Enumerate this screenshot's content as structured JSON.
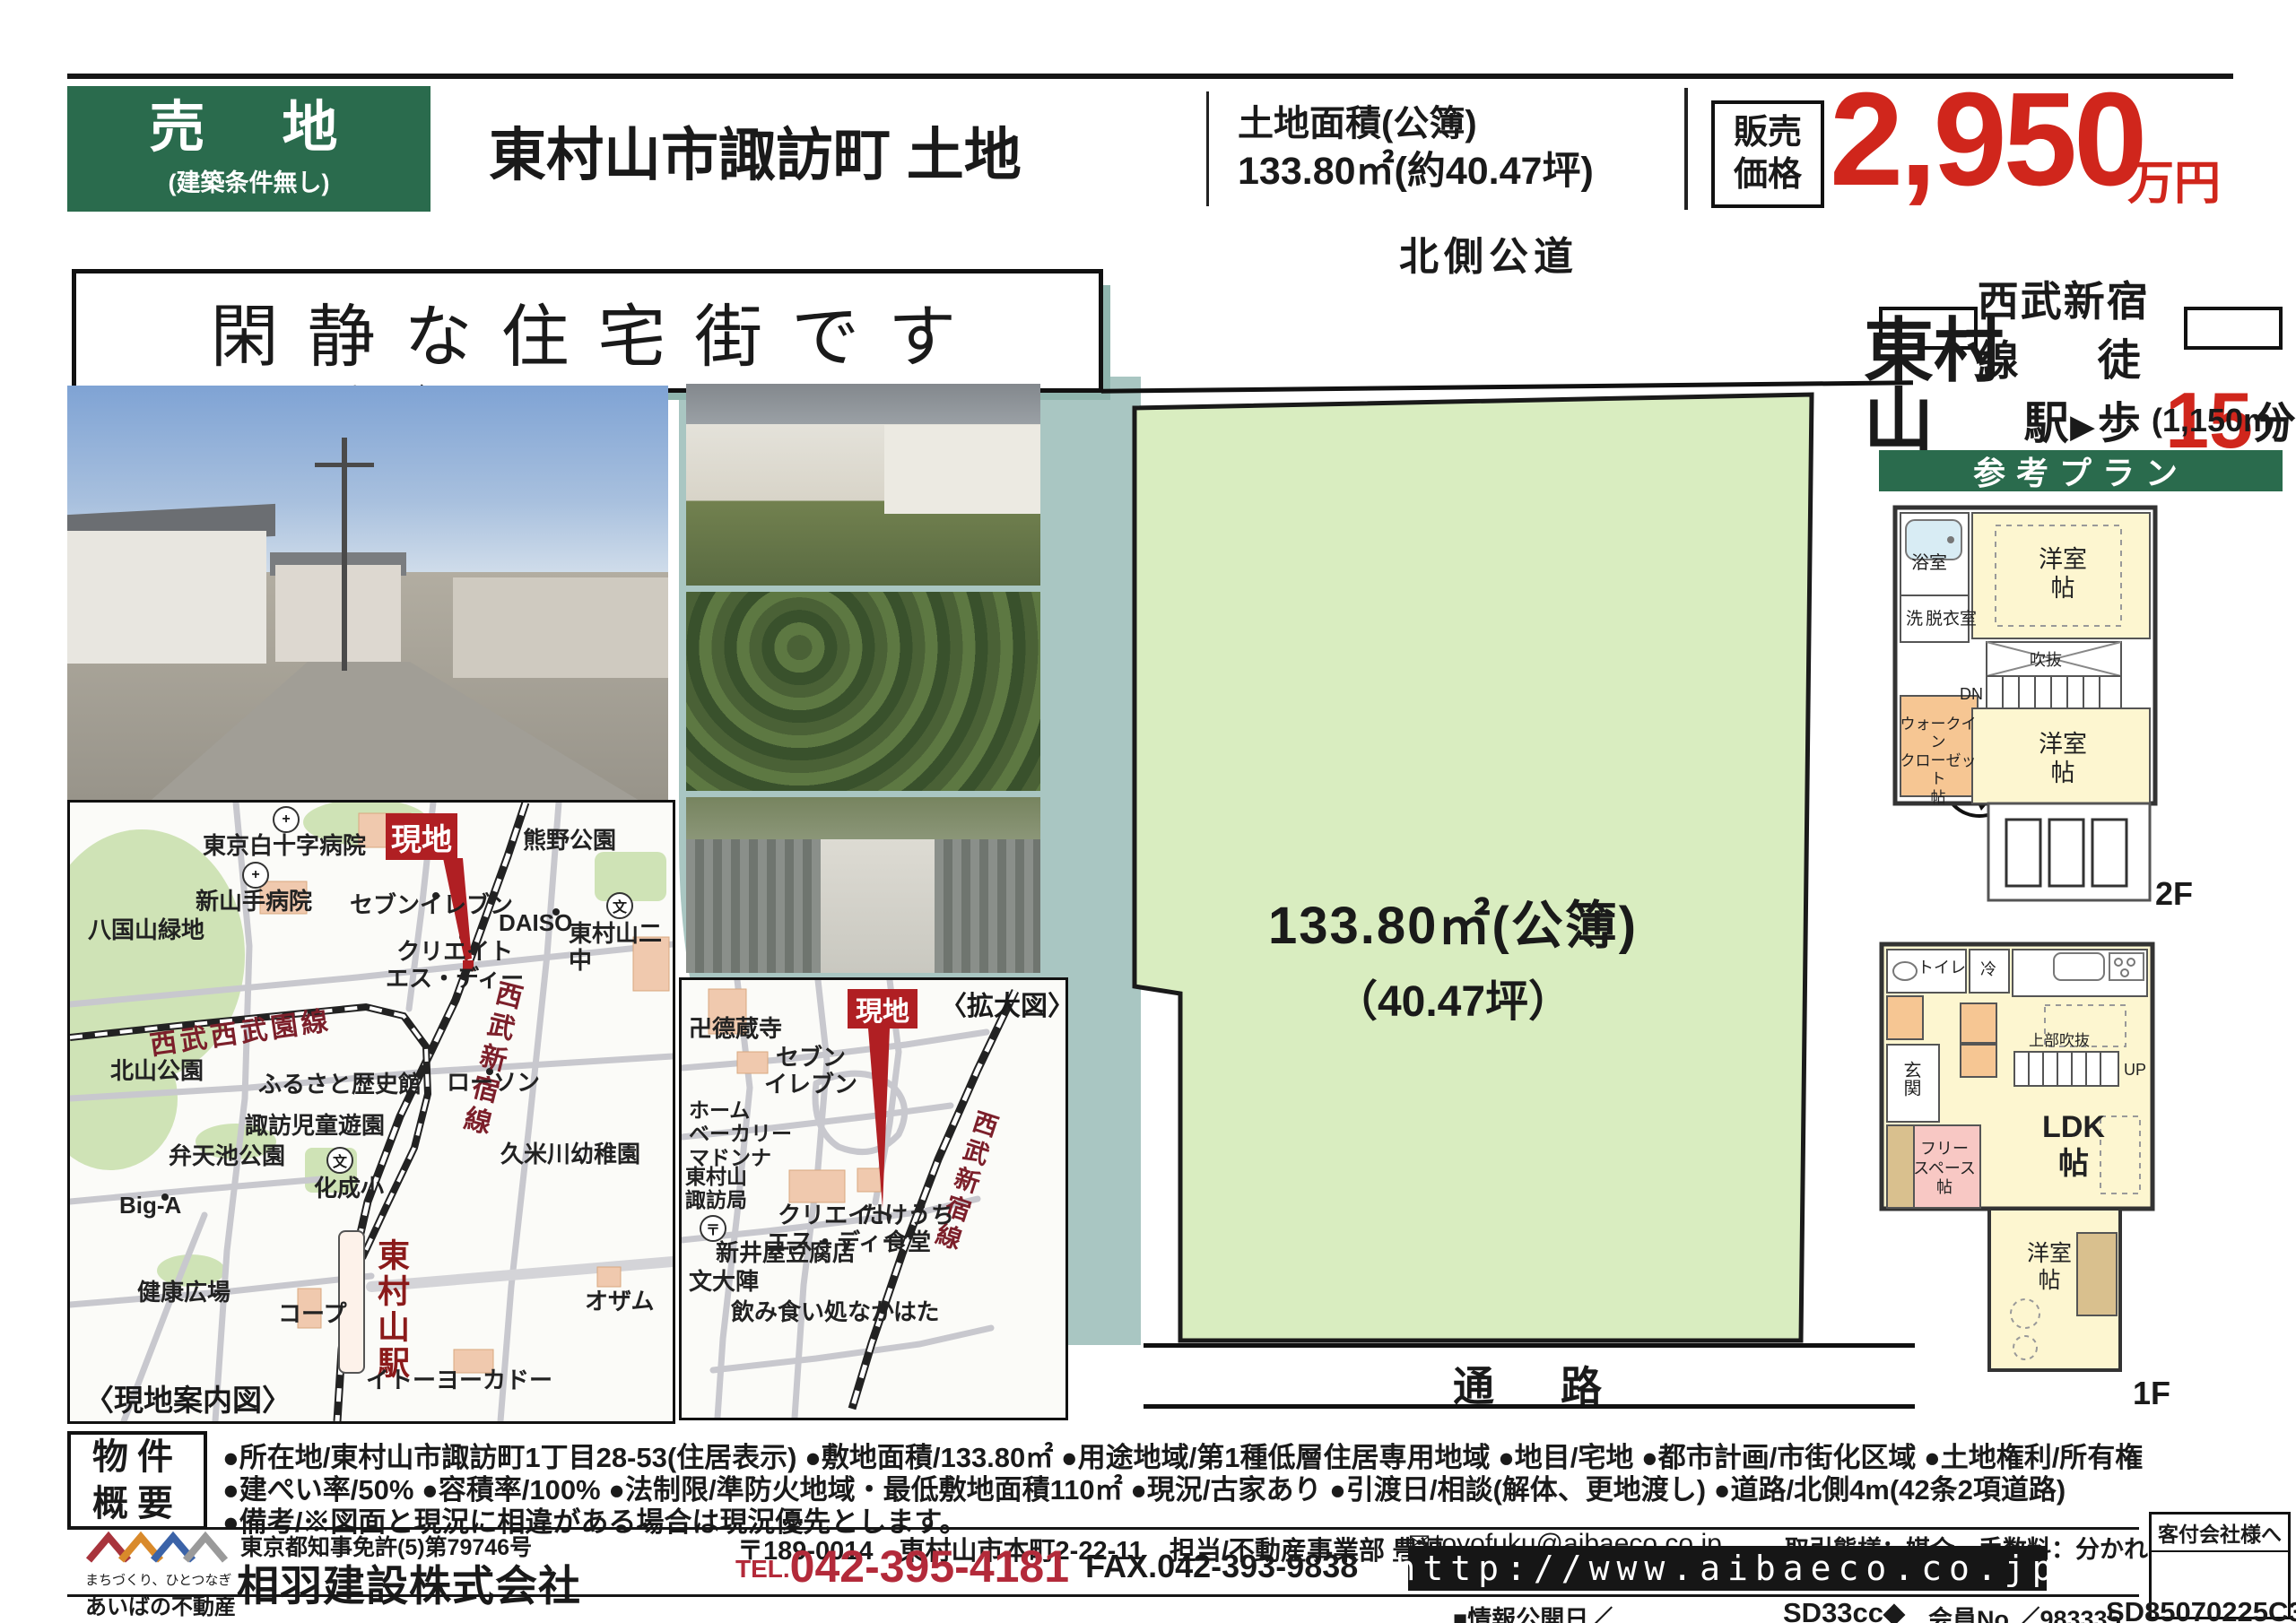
{
  "header": {
    "sale_type": "売　地",
    "sale_condition": "(建築条件無し)",
    "title": "東村山市諏訪町 土地",
    "area_label": "土地面積(公簿)",
    "area_value": "133.80㎡(約40.47坪)",
    "price_label": "販売\n価格",
    "price_value": "2,950",
    "price_unit": "万円"
  },
  "catchphrase": "閑静な住宅街です",
  "access": {
    "line_name": "西武新宿線",
    "station": "東村山",
    "station_suffix": "駅",
    "arrow": "▶",
    "walk_label": "徒歩",
    "walk_minutes": "15",
    "minutes_suffix": "分",
    "distance": "(1,150m)"
  },
  "plan": {
    "banner": "参考プラン",
    "floor2": {
      "bath": "浴室",
      "wash": "洗",
      "dressing": "脱衣室",
      "room1": "洋室\n帖",
      "void": "吹抜",
      "down": "DN",
      "wic": "ウォークイン\nクローゼット\n帖",
      "room2": "洋室\n帖",
      "floor_label": "2F"
    },
    "floor1": {
      "toilet": "トイレ",
      "fridge": "冷",
      "entrance": "玄関",
      "free_space": "フリー\nスペース\n帖",
      "upper_void": "上部吹抜",
      "up": "UP",
      "ldk": "LDK\n帖",
      "room": "洋室\n帖",
      "floor_label": "1F"
    }
  },
  "plot": {
    "north_road": "北側公道",
    "area_line1": "133.80㎡(公簿)",
    "area_line2": "（40.47坪）",
    "passage": "通　路",
    "compass_n": "N"
  },
  "maps": {
    "guide_caption": "〈現地案内図〉",
    "enlarged_caption": "〈拡大図〉",
    "site_marker": "現地",
    "icons": {
      "hospital": "+",
      "school": "文",
      "post": "〒",
      "email": "✉"
    },
    "guide_labels": [
      "東京白十字病院",
      "熊野公園",
      "新山手病院",
      "八国山緑地",
      "セブンイレブン",
      "DAISO",
      "東村山二中",
      "クリエイト\nエス・ディー",
      "西武新宿線",
      "西武西武園線",
      "北山公園",
      "ふるさと歴史館",
      "諏訪児童遊園",
      "ローソン",
      "化成小",
      "弁天池公園",
      "Big-A",
      "健康広場",
      "コープ",
      "東村山駅",
      "イトーヨーカドー",
      "久米川幼稚園",
      "オザム"
    ],
    "enlarged_labels": [
      "卍德蔵寺",
      "セブン\nイレブン",
      "ホーム\nベーカリー\nマドンナ",
      "西武新宿線",
      "クリエイト\nエス・ディー",
      "たけうち\n食堂",
      "新井屋豆腐店",
      "東村山\n諏訪局",
      "文大陣",
      "飲み食い処なかはた"
    ]
  },
  "outline": {
    "box_label": "物件\n概要",
    "line1": "●所在地/東村山市諏訪町1丁目28-53(住居表示) ●敷地面積/133.80㎡ ●用途地域/第1種低層住居専用地域 ●地目/宅地 ●都市計画/市街化区域 ●土地権利/所有権",
    "line2": "●建ぺい率/50% ●容積率/100% ●法制限/準防火地域・最低敷地面積110㎡ ●現況/古家あり ●引渡日/相談(解体、更地渡し) ●道路/北側4m(42条2項道路)",
    "line3": "●備考/※図面と現況に相違がある場合は現況優先とします。"
  },
  "footer": {
    "logo_tagline": "まちづくり、ひとつなぎ",
    "logo_name": "あいばの不動産",
    "license": "東京都知事免許(5)第79746号",
    "company": "相羽建設株式会社",
    "address": "〒189-0014　東村山市本町2-22-11　担当/不動産事業部 豊福",
    "tel_label": "TEL.",
    "tel_number": "042-395-4181",
    "fax": "FAX.042-393-9838",
    "email": "toyofuku@aibaeco.co.jp",
    "deal_terms": "取引態様：媒介　手数料：分かれ",
    "url": "http://www.aibaeco.co.jp",
    "info_date": "■情報公開日／",
    "code1": "SD33cc◆",
    "member_no": "会員No.／983335",
    "code2": "SD85070225C305",
    "agent_box_label": "客付会社様へ"
  },
  "colors": {
    "brand_green": "#2a6b4d",
    "price_red": "#d0261c",
    "tel_red": "#b32a3a",
    "marker_red": "#b01f23",
    "rail_label_red": "#7c1f2a",
    "plot_green": "#d9edc0",
    "teal": "#a9c6c2"
  }
}
